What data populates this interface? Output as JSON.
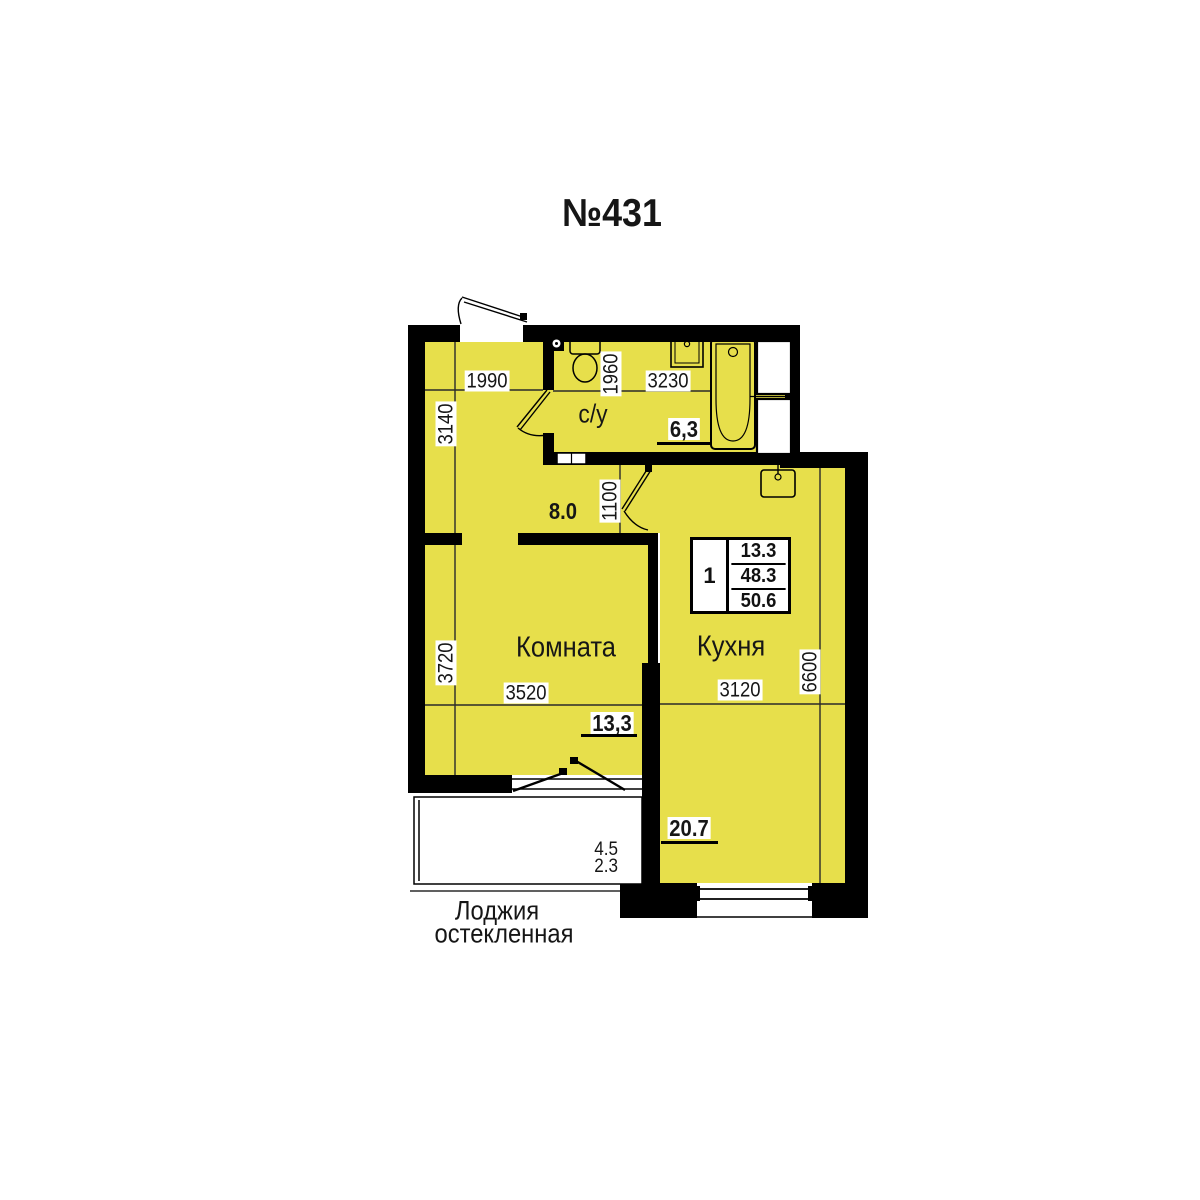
{
  "title": "№431",
  "colors": {
    "room_fill": "#e7df4b",
    "wall": "#000000",
    "label_text": "#161616",
    "white": "#ffffff"
  },
  "info_table": {
    "rooms_count": "1",
    "living_area": "13.3",
    "area_without_loggia": "48.3",
    "total_area": "50.6"
  },
  "rooms": {
    "hall": {
      "area": "8.0"
    },
    "bathroom": {
      "name": "с/у",
      "area": "6,3"
    },
    "living_room": {
      "name": "Комната",
      "area": "13,3"
    },
    "kitchen": {
      "name": "Кухня",
      "area": "20.7"
    },
    "loggia": {
      "name_line1": "Лоджия",
      "name_line2": "остекленная",
      "area_full": "4.5",
      "area_counted": "2.3"
    }
  },
  "dimensions_mm": {
    "hall_width": "1990",
    "hall_depth": "3140",
    "hall_passage": "1100",
    "bathroom_width": "3230",
    "bathroom_depth": "1960",
    "living_width": "3520",
    "living_depth": "3720",
    "kitchen_width": "3120",
    "kitchen_depth": "6600"
  }
}
